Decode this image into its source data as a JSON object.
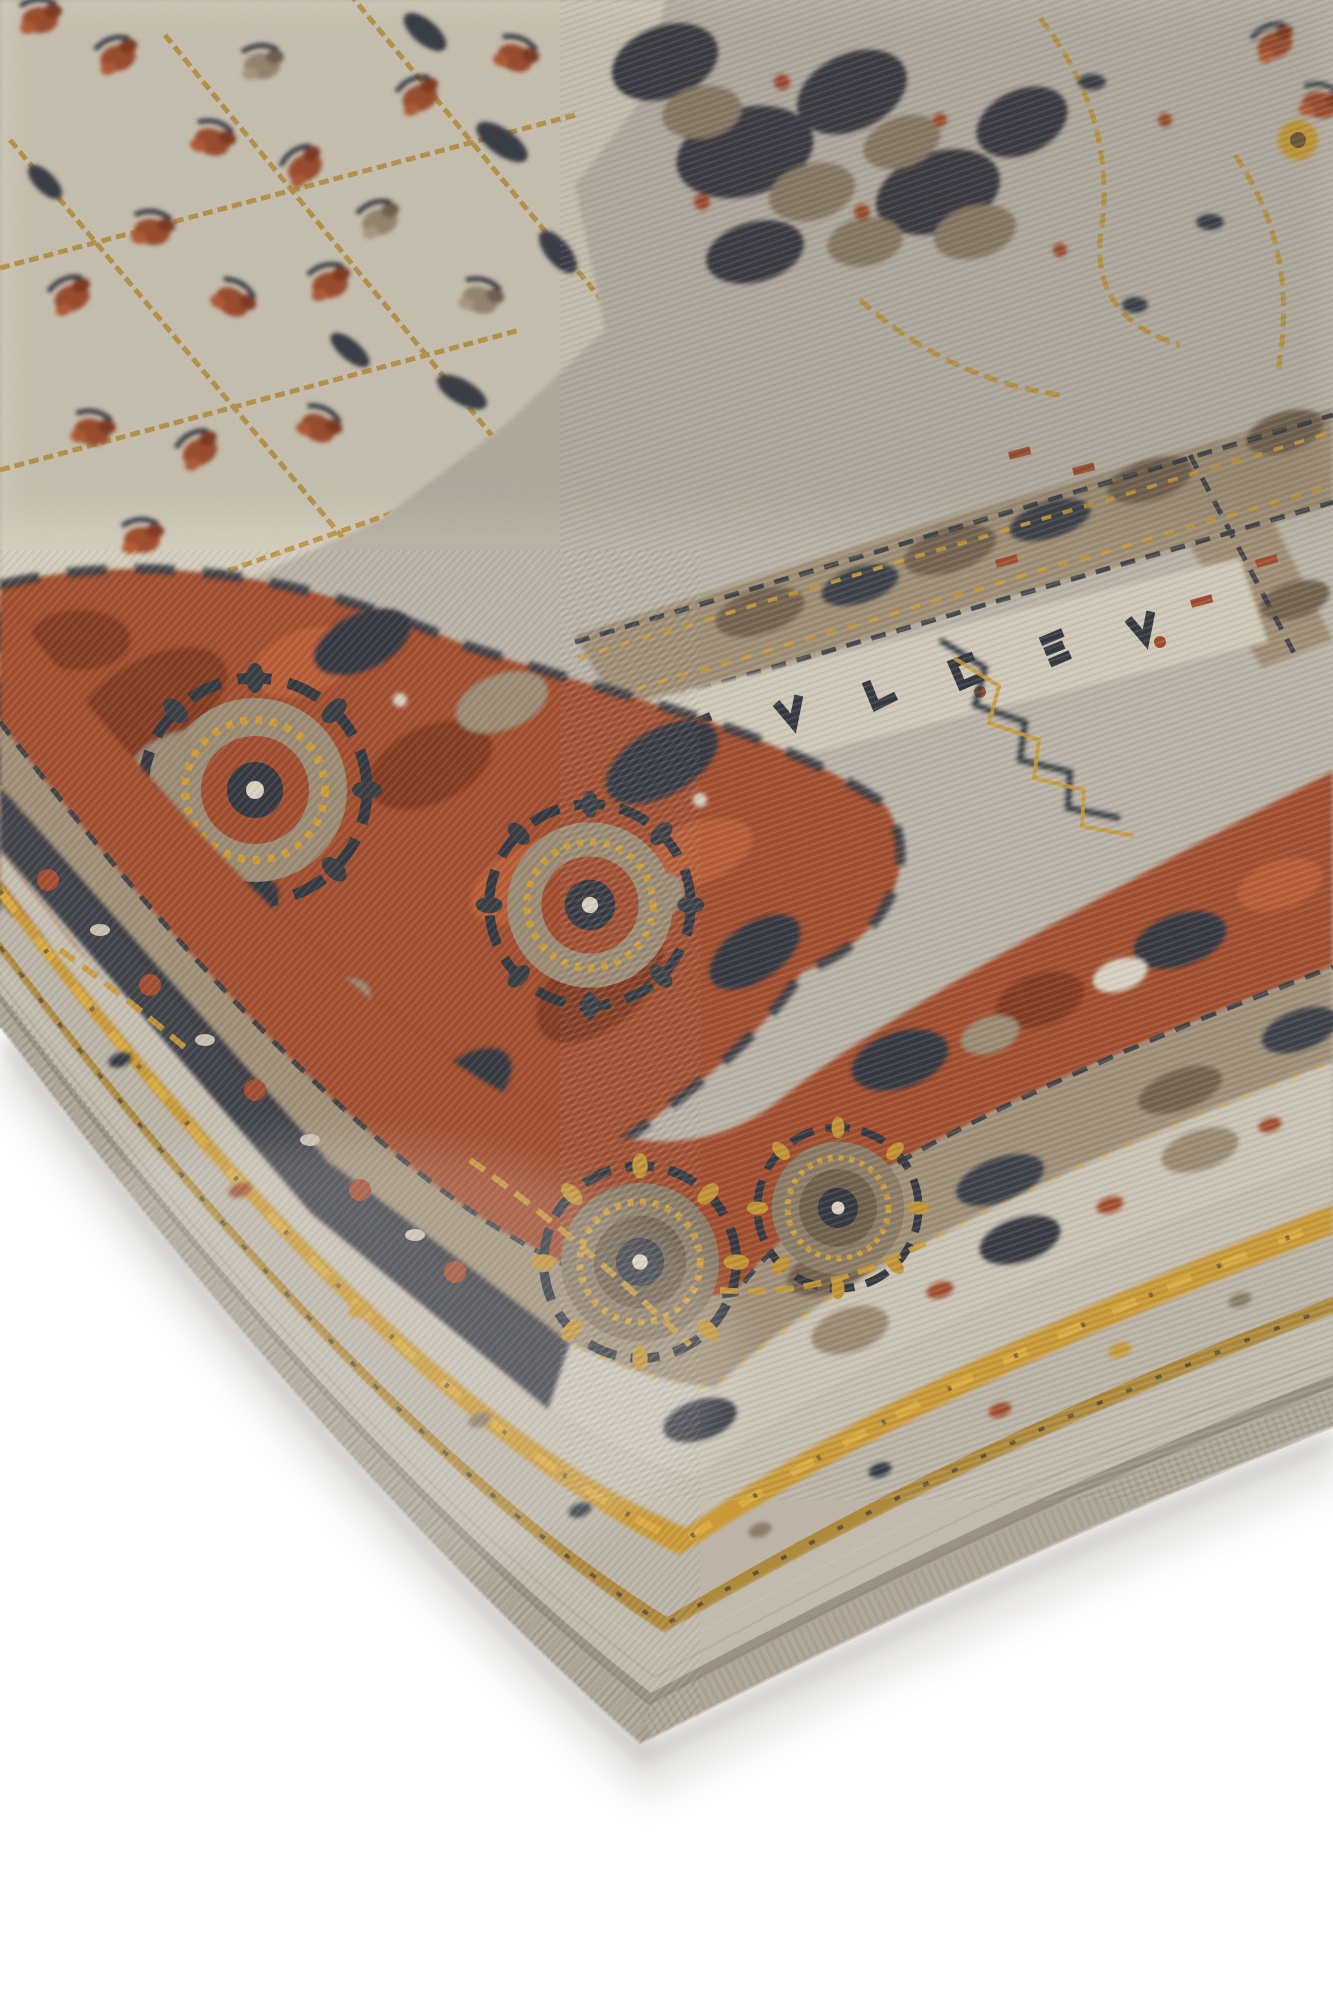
{
  "scene": {
    "alt": "Close-up corner of a distressed vintage oriental-style area rug laid on a plain white background, photographed at a low angle",
    "background_color": "#ffffff",
    "shadow_color": "#b5b2ac"
  },
  "rug": {
    "style": "distressed traditional medallion rug, corner detail",
    "palette": {
      "binding_gray": "#b3ac9e",
      "pile_light_gray": "#c8c1b4",
      "field_silver": "#c0b9ad",
      "ivory_cream": "#dcd5c4",
      "gold_ochre": "#d29c30",
      "gold_dark": "#b28a38",
      "rust_red": "#a4482b",
      "rust_dark": "#83361f",
      "rust_bright": "#bd5a33",
      "charcoal_navy": "#2d323c",
      "taupe_brown": "#9d8c74",
      "brown_dark": "#6f5f4d"
    },
    "regions": [
      "serged binding edge",
      "outer gray guard band",
      "thin gold pinstripe",
      "speckled gray band",
      "wide gold stripe",
      "ivory guard strip with motifs",
      "taupe border band",
      "rust red main border with rosettes",
      "navy minor band with red florets",
      "silver-gray field with gold vines",
      "ivory field patch with floral sprays",
      "gold-ringed rosette medallions"
    ]
  }
}
